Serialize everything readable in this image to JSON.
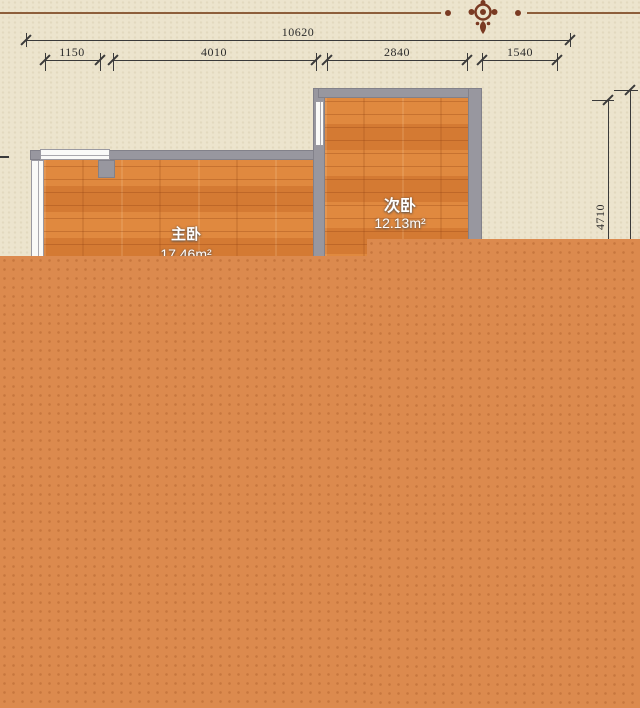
{
  "plan": {
    "type": "floor-plan",
    "ornament_icon": "floral-medallion"
  },
  "dimensions": {
    "total_width": {
      "label": "10620"
    },
    "segments": [
      {
        "label": "1150"
      },
      {
        "label": "4010"
      },
      {
        "label": "2840"
      },
      {
        "label": "1540"
      }
    ],
    "right_height": {
      "label": "4710"
    }
  },
  "rooms": [
    {
      "name": "主卧",
      "area": "17.46m²"
    },
    {
      "name": "次卧",
      "area": "12.13m²"
    }
  ],
  "colors": {
    "background": "#ece4cd",
    "overlay": "#dc8a4e",
    "wall": "#98979f",
    "floor": "#d8803c",
    "dimension_line": "#3a3a3a",
    "ornament": "#7a3a22",
    "room_label": "#ffffff",
    "deco_line": "#8d5e3b"
  }
}
